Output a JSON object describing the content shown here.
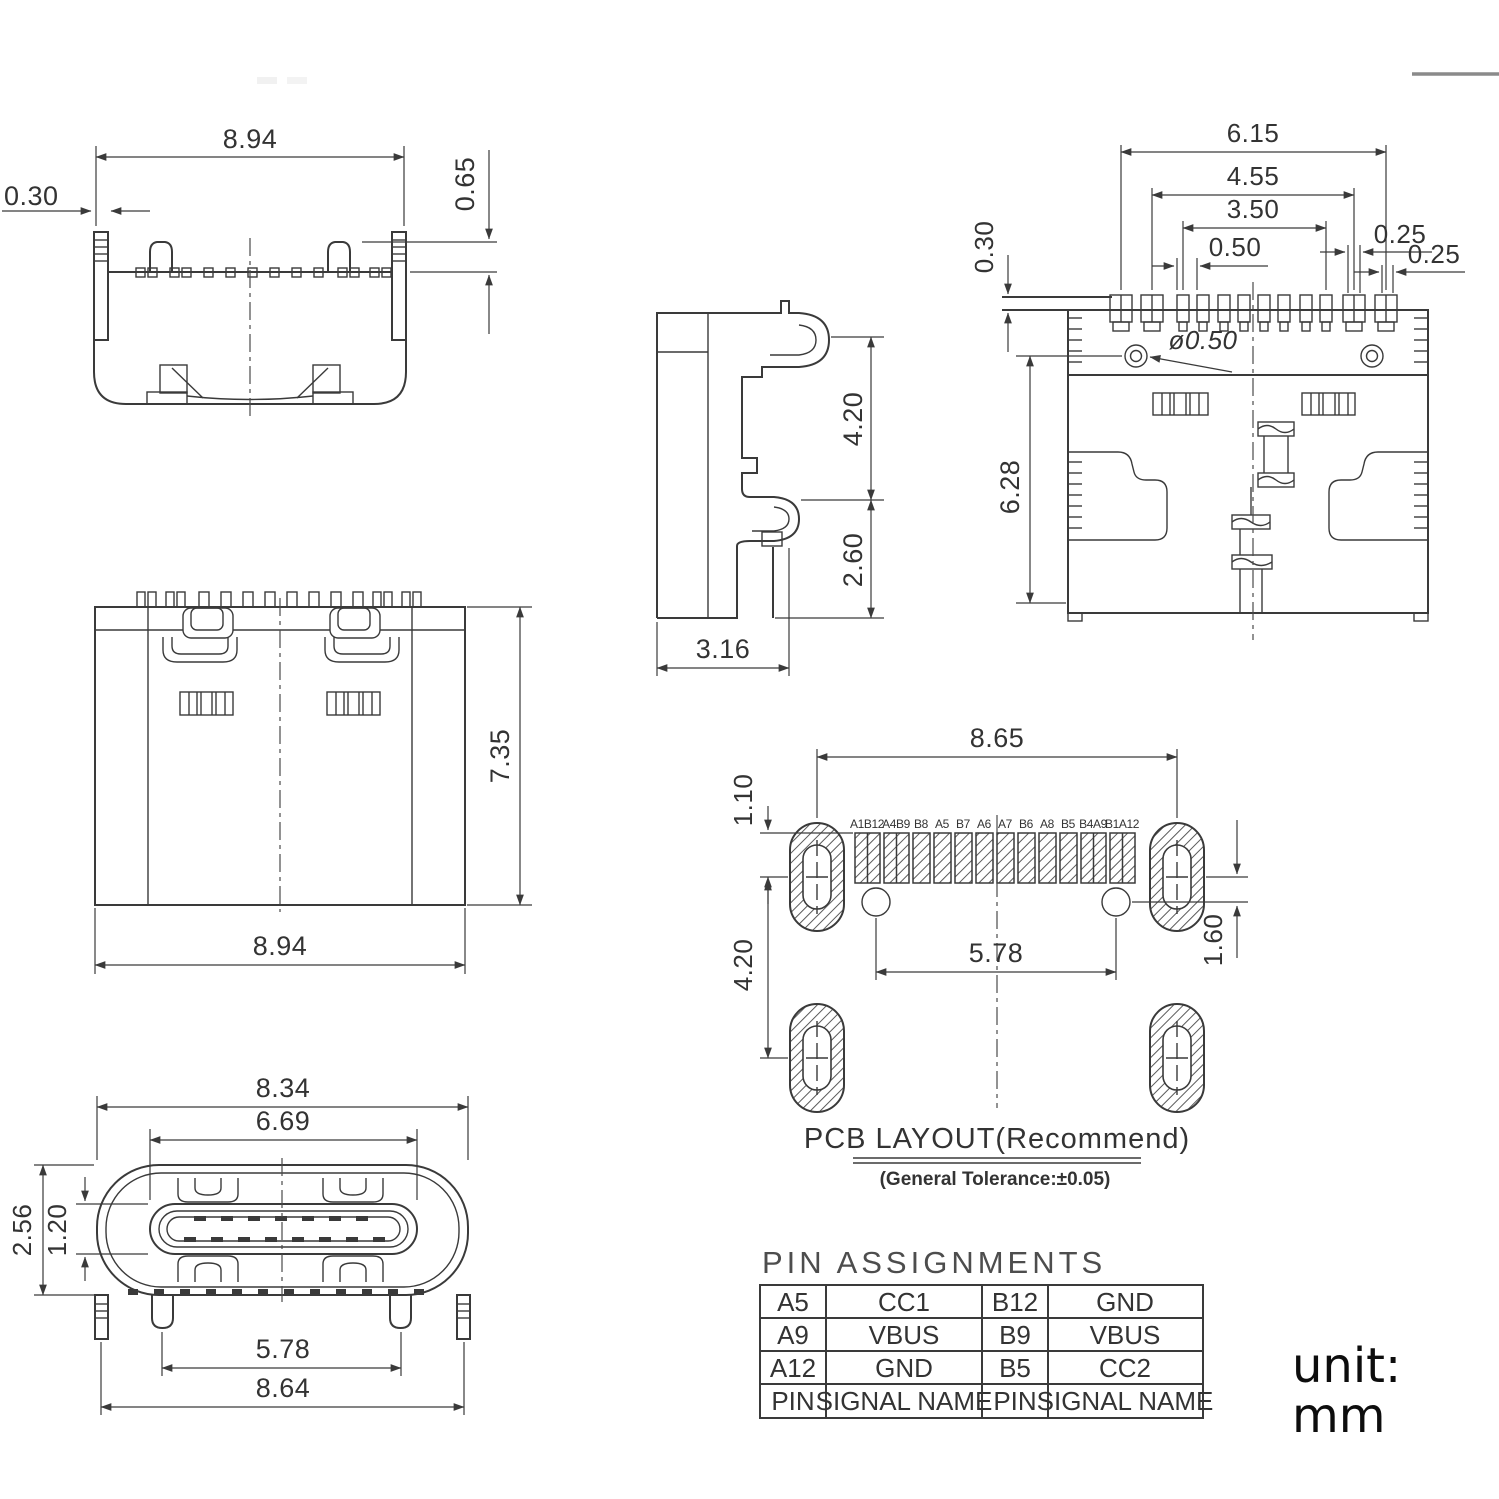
{
  "views": {
    "front": {
      "width": "8.94",
      "tab_thickness": "0.30",
      "peg_height": "0.65"
    },
    "side": {
      "upper_height": "4.20",
      "lower_height": "2.60",
      "depth": "3.16"
    },
    "back": {
      "span1": "6.15",
      "span2": "4.55",
      "span3": "3.50",
      "pitch": "0.50",
      "pin_w1": "0.25",
      "pin_w2": "0.25",
      "lip": "0.30",
      "hole_dia": "ø0.50",
      "height": "6.28"
    },
    "top": {
      "height": "7.35",
      "width": "8.94"
    },
    "pcb": {
      "title": "PCB LAYOUT(Recommend)",
      "subtitle": "(General Tolerance:±0.05)",
      "pad_span": "8.65",
      "pad_offset": "1.10",
      "row_gap": "4.20",
      "hole_span": "5.78",
      "edge_offset": "1.60",
      "labels": [
        "A1B12",
        "A4B9",
        "B8",
        "A5",
        "B7",
        "A6",
        "A7",
        "B6",
        "A8",
        "B5",
        "B4A9",
        "B1A12"
      ]
    },
    "mating": {
      "outer_width": "8.34",
      "opening_width": "6.69",
      "outer_height": "2.56",
      "slot_height": "1.20",
      "leg_span": "5.78",
      "total_width": "8.64"
    }
  },
  "pin_table": {
    "title": "PIN  ASSIGNMENTS",
    "rows": [
      [
        "A5",
        "CC1",
        "B12",
        "GND"
      ],
      [
        "A9",
        "VBUS",
        "B9",
        "VBUS"
      ],
      [
        "A12",
        "GND",
        "B5",
        "CC2"
      ],
      [
        "PIN",
        "SIGNAL NAME",
        "PIN",
        "SIGNAL NAME"
      ]
    ]
  },
  "unit": {
    "label": "unit:",
    "value": "mm"
  }
}
